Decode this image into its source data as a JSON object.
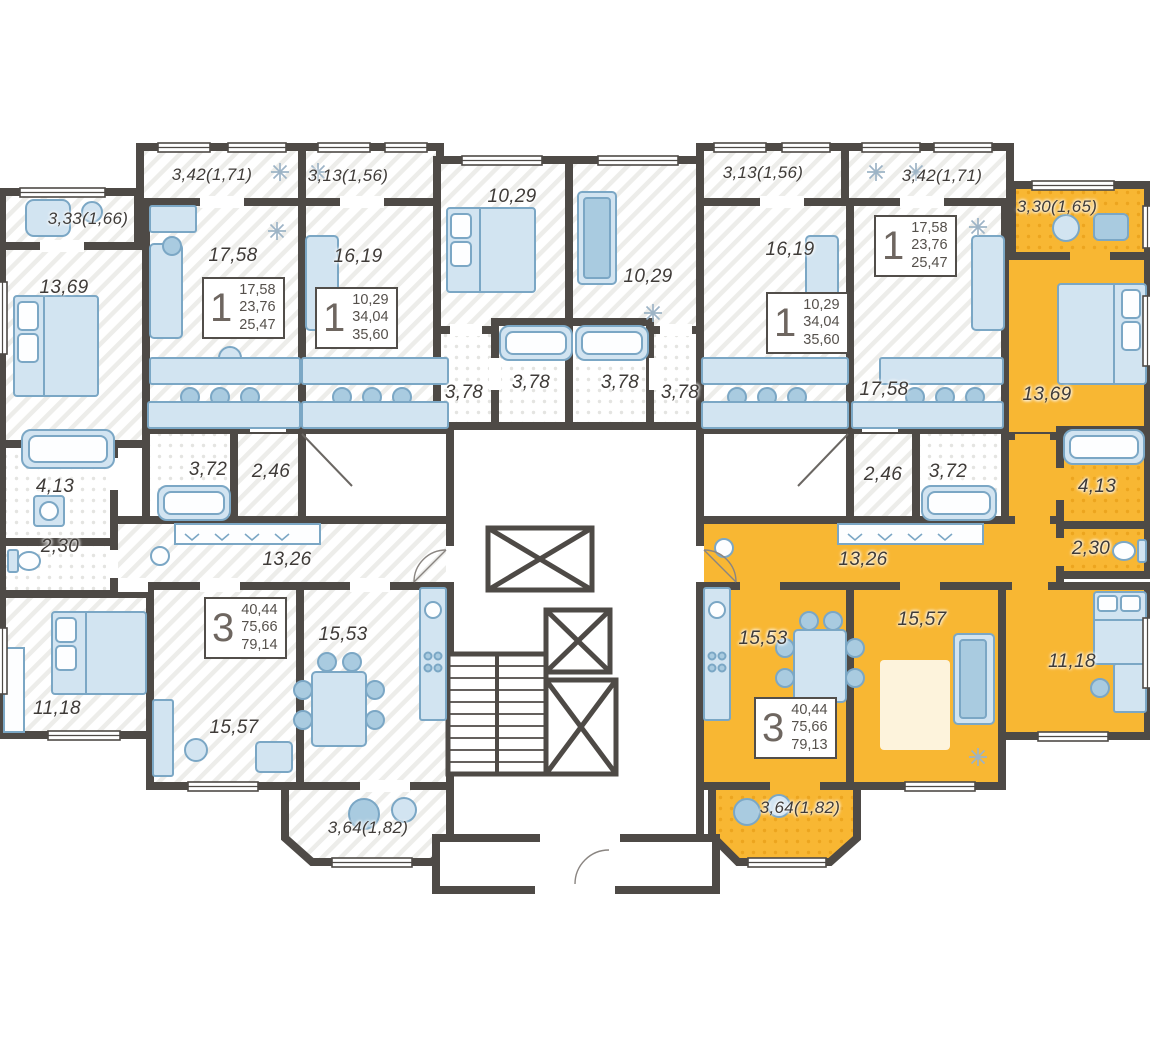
{
  "plan": {
    "type": "residential-floor-plan",
    "colors": {
      "highlight_apartment": "#F8B733",
      "walls": "#4E4A46",
      "furniture": "#D2E4F1",
      "label_text": "#3F3B38"
    },
    "labels": [
      {
        "text": "3,33(1,66)"
      },
      {
        "text": "3,42(1,71)"
      },
      {
        "text": "3,13(1,56)"
      },
      {
        "text": "10,29"
      },
      {
        "text": "10,29"
      },
      {
        "text": "3,13(1,56)"
      },
      {
        "text": "3,42(1,71)"
      },
      {
        "text": "3,30(1,65)"
      },
      {
        "text": "13,69"
      },
      {
        "text": "17,58"
      },
      {
        "text": "16,19"
      },
      {
        "text": "16,19"
      },
      {
        "text": "17,58"
      },
      {
        "text": "13,69"
      },
      {
        "text": "3,78"
      },
      {
        "text": "3,78"
      },
      {
        "text": "3,78"
      },
      {
        "text": "3,78"
      },
      {
        "text": "3,72"
      },
      {
        "text": "2,46"
      },
      {
        "text": "2,46"
      },
      {
        "text": "3,72"
      },
      {
        "text": "4,13"
      },
      {
        "text": "2,30"
      },
      {
        "text": "4,13"
      },
      {
        "text": "2,30"
      },
      {
        "text": "13,26"
      },
      {
        "text": "13,26"
      },
      {
        "text": "15,53"
      },
      {
        "text": "15,57"
      },
      {
        "text": "11,18"
      },
      {
        "text": "15,53"
      },
      {
        "text": "15,57"
      },
      {
        "text": "11,18"
      },
      {
        "text": "3,64(1,82)"
      },
      {
        "text": "3,64(1,82)"
      }
    ],
    "cards": [
      {
        "rooms": "1",
        "areas": [
          "17,58",
          "23,76",
          "25,47"
        ]
      },
      {
        "rooms": "1",
        "areas": [
          "10,29",
          "34,04",
          "35,60"
        ]
      },
      {
        "rooms": "1",
        "areas": [
          "10,29",
          "34,04",
          "35,60"
        ]
      },
      {
        "rooms": "1",
        "areas": [
          "17,58",
          "23,76",
          "25,47"
        ]
      },
      {
        "rooms": "3",
        "areas": [
          "40,44",
          "75,66",
          "79,14"
        ]
      },
      {
        "rooms": "3",
        "areas": [
          "40,44",
          "75,66",
          "79,13"
        ]
      }
    ]
  }
}
